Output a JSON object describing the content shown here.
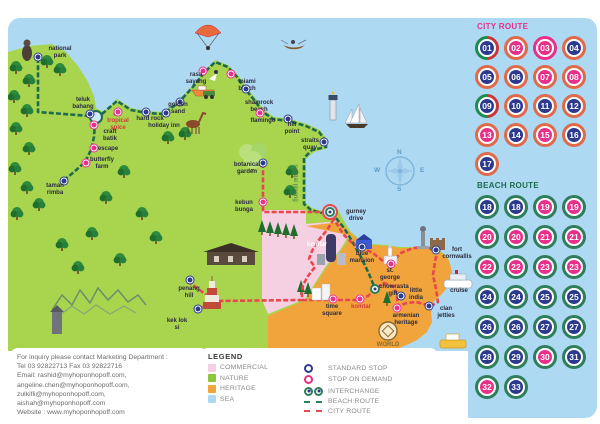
{
  "panels": {
    "city": {
      "title": "CITY ROUTE",
      "badges": [
        {
          "n": "01",
          "fill": "navy",
          "ring": "split"
        },
        {
          "n": "02",
          "fill": "pink",
          "ring": "orange"
        },
        {
          "n": "03",
          "fill": "pink",
          "ring": "pink"
        },
        {
          "n": "04",
          "fill": "navy",
          "ring": "orange"
        },
        {
          "n": "05",
          "fill": "navy",
          "ring": "orange"
        },
        {
          "n": "06",
          "fill": "navy",
          "ring": "orange"
        },
        {
          "n": "07",
          "fill": "pink",
          "ring": "orange"
        },
        {
          "n": "08",
          "fill": "pink",
          "ring": "orange"
        },
        {
          "n": "09",
          "fill": "navy",
          "ring": "split"
        },
        {
          "n": "10",
          "fill": "navy",
          "ring": "orange"
        },
        {
          "n": "11",
          "fill": "navy",
          "ring": "orange"
        },
        {
          "n": "12",
          "fill": "navy",
          "ring": "orange"
        },
        {
          "n": "13",
          "fill": "pink",
          "ring": "orange"
        },
        {
          "n": "14",
          "fill": "navy",
          "ring": "orange"
        },
        {
          "n": "15",
          "fill": "pink",
          "ring": "orange"
        },
        {
          "n": "16",
          "fill": "navy",
          "ring": "orange"
        },
        {
          "n": "17",
          "fill": "navy",
          "ring": "orange"
        }
      ]
    },
    "beach": {
      "title": "BEACH ROUTE",
      "badges": [
        {
          "n": "18",
          "fill": "navy",
          "ring": "green"
        },
        {
          "n": "18",
          "fill": "navy",
          "ring": "green"
        },
        {
          "n": "19",
          "fill": "pink",
          "ring": "green"
        },
        {
          "n": "19",
          "fill": "pink",
          "ring": "green"
        },
        {
          "n": "20",
          "fill": "pink",
          "ring": "green"
        },
        {
          "n": "20",
          "fill": "pink",
          "ring": "green"
        },
        {
          "n": "21",
          "fill": "pink",
          "ring": "green"
        },
        {
          "n": "21",
          "fill": "pink",
          "ring": "green"
        },
        {
          "n": "22",
          "fill": "pink",
          "ring": "green"
        },
        {
          "n": "22",
          "fill": "pink",
          "ring": "green"
        },
        {
          "n": "23",
          "fill": "pink",
          "ring": "green"
        },
        {
          "n": "23",
          "fill": "pink",
          "ring": "green"
        },
        {
          "n": "24",
          "fill": "navy",
          "ring": "green"
        },
        {
          "n": "24",
          "fill": "navy",
          "ring": "green"
        },
        {
          "n": "25",
          "fill": "navy",
          "ring": "green"
        },
        {
          "n": "25",
          "fill": "navy",
          "ring": "green"
        },
        {
          "n": "26",
          "fill": "navy",
          "ring": "green"
        },
        {
          "n": "26",
          "fill": "navy",
          "ring": "green"
        },
        {
          "n": "27",
          "fill": "navy",
          "ring": "green"
        },
        {
          "n": "27",
          "fill": "navy",
          "ring": "green"
        },
        {
          "n": "28",
          "fill": "navy",
          "ring": "green"
        },
        {
          "n": "29",
          "fill": "navy",
          "ring": "green"
        },
        {
          "n": "30",
          "fill": "pink",
          "ring": "green"
        },
        {
          "n": "31",
          "fill": "navy",
          "ring": "green"
        },
        {
          "n": "32",
          "fill": "pink",
          "ring": "green"
        },
        {
          "n": "33",
          "fill": "navy",
          "ring": "green"
        }
      ]
    }
  },
  "colors": {
    "navy": "#2b3a8f",
    "pink": "#e8308a",
    "orange_ring": "#e0694a",
    "pink_ring": "#e8308a",
    "green_ring": "#2e7d5b",
    "split_a": "#1d8a4f",
    "split_b": "#c83737",
    "sea": "#aed9f2",
    "land": "#a8d44e",
    "commercial": "#f5cfe2",
    "heritage": "#f2a43c",
    "city_route": "#e8474b",
    "beach_route": "#1d6b4f"
  },
  "map": {
    "compass": {
      "n": "N",
      "e": "E",
      "s": "S",
      "w": "W"
    },
    "places": [
      {
        "label": "national park",
        "lx": 44,
        "ly": 46,
        "w": 32,
        "sx": 38,
        "sy": 57,
        "type": "standard"
      },
      {
        "label": "teluk bahang",
        "lx": 66,
        "ly": 97,
        "w": 34,
        "sx": 90,
        "sy": 114,
        "type": "standard"
      },
      {
        "label": "craft batik",
        "lx": 97,
        "ly": 129,
        "w": 26,
        "sx": 94,
        "sy": 125,
        "type": "demand"
      },
      {
        "label": "tropical spice",
        "lx": 102,
        "ly": 118,
        "w": 32,
        "sx": 118,
        "sy": 112,
        "type": "demand",
        "color": "#d23b3b"
      },
      {
        "label": "escape",
        "lx": 97,
        "ly": 146,
        "w": 22,
        "sx": 94,
        "sy": 148,
        "type": "demand"
      },
      {
        "label": "butterfly farm",
        "lx": 88,
        "ly": 157,
        "w": 28,
        "sx": 86,
        "sy": 163,
        "type": "demand"
      },
      {
        "label": "taman rimba",
        "lx": 42,
        "ly": 183,
        "w": 26,
        "sx": 64,
        "sy": 181,
        "type": "standard"
      },
      {
        "label": "hard rock",
        "lx": 136,
        "ly": 116,
        "w": 28,
        "sx": 146,
        "sy": 112,
        "type": "standard"
      },
      {
        "label": "holiday inn",
        "lx": 148,
        "ly": 123,
        "w": 32,
        "sx": 166,
        "sy": 113,
        "type": "standard"
      },
      {
        "label": "golden sand",
        "lx": 165,
        "ly": 102,
        "w": 26,
        "sx": 180,
        "sy": 102,
        "type": "standard"
      },
      {
        "label": "rasa sayang",
        "lx": 184,
        "ly": 72,
        "w": 24,
        "sx": 203,
        "sy": 71,
        "type": "demand"
      },
      {
        "label": "miami beach",
        "lx": 234,
        "ly": 79,
        "w": 26,
        "sx": 231,
        "sy": 74,
        "type": "demand"
      },
      {
        "label": "shamrock beach",
        "lx": 243,
        "ly": 100,
        "w": 32,
        "sx": 246,
        "sy": 89,
        "type": "standard"
      },
      {
        "label": "flamingo",
        "lx": 250,
        "ly": 118,
        "w": 26,
        "sx": 260,
        "sy": 113,
        "type": "demand"
      },
      {
        "label": "hill point",
        "lx": 281,
        "ly": 122,
        "w": 22,
        "sx": 288,
        "sy": 119,
        "type": "standard"
      },
      {
        "label": "straits quay",
        "lx": 296,
        "ly": 138,
        "w": 28,
        "sx": 324,
        "sy": 142,
        "type": "standard"
      },
      {
        "label": "botanical garden",
        "lx": 232,
        "ly": 162,
        "w": 30,
        "sx": 263,
        "sy": 163,
        "type": "standard"
      },
      {
        "label": "kebun bunga",
        "lx": 228,
        "ly": 200,
        "w": 32,
        "sx": 263,
        "sy": 202,
        "type": "demand"
      },
      {
        "label": "gurney drive",
        "lx": 344,
        "ly": 209,
        "w": 24,
        "sx": 330,
        "sy": 212,
        "type": "interchange"
      },
      {
        "label": "penang hill",
        "lx": 174,
        "ly": 286,
        "w": 30,
        "sx": 190,
        "sy": 280,
        "type": "standard"
      },
      {
        "label": "kek lok si",
        "lx": 164,
        "ly": 318,
        "w": 26,
        "sx": 198,
        "sy": 309,
        "type": "standard"
      },
      {
        "label": "time square",
        "lx": 320,
        "ly": 304,
        "w": 24,
        "sx": 333,
        "sy": 299,
        "type": "demand"
      },
      {
        "label": "komtar",
        "lx": 350,
        "ly": 304,
        "w": 22,
        "sx": 360,
        "sy": 299,
        "type": "demand",
        "color": "#d23b3b"
      },
      {
        "label": "chowrasta gift",
        "lx": 379,
        "ly": 284,
        "w": 28,
        "sx": 375,
        "sy": 289,
        "type": "interchange"
      },
      {
        "label": "blue mansion",
        "lx": 348,
        "ly": 251,
        "w": 28,
        "sx": 362,
        "sy": 247,
        "type": "standard"
      },
      {
        "label": "st. george",
        "lx": 378,
        "ly": 268,
        "w": 24,
        "sx": 391,
        "sy": 264,
        "type": "demand"
      },
      {
        "label": "fort cornwallis",
        "lx": 442,
        "ly": 247,
        "w": 30,
        "sx": 436,
        "sy": 250,
        "type": "standard"
      },
      {
        "label": "little india",
        "lx": 405,
        "ly": 288,
        "w": 22,
        "sx": 401,
        "sy": 296,
        "type": "standard"
      },
      {
        "label": "clan jetties",
        "lx": 435,
        "ly": 306,
        "w": 22,
        "sx": 429,
        "sy": 306,
        "type": "standard"
      },
      {
        "label": "armenian heritage",
        "lx": 392,
        "ly": 313,
        "w": 28,
        "sx": 397,
        "sy": 308,
        "type": "demand"
      },
      {
        "label": "cruise",
        "lx": 448,
        "ly": 288,
        "w": 22,
        "type": "none"
      },
      {
        "label": "komtar",
        "lx": 306,
        "ly": 242,
        "w": 22,
        "type": "none",
        "color": "#ffffff"
      },
      {
        "label": "WORLD HERITAGE",
        "lx": 370,
        "ly": 342,
        "w": 36,
        "type": "none",
        "color": "#8a6a2a"
      },
      {
        "label": "sungai pinang",
        "lx": 298,
        "ly": 162,
        "w": 42,
        "type": "none",
        "color": "#4a7a3a",
        "rot": 90
      }
    ]
  },
  "legend": {
    "title": "LEGEND",
    "areas": [
      {
        "label": "COMMERCIAL",
        "color": "#f5cfe2"
      },
      {
        "label": "NATURE",
        "color": "#8cc63f"
      },
      {
        "label": "HERITAGE",
        "color": "#f2a43c"
      },
      {
        "label": "SEA",
        "color": "#aed9f2"
      }
    ],
    "symbols": [
      {
        "label": "STANDARD STOP",
        "type": "standard"
      },
      {
        "label": "STOP ON DEMAND",
        "type": "demand"
      },
      {
        "label": "INTERCHANGE",
        "type": "interchange"
      },
      {
        "label": "BEACH ROUTE",
        "type": "beach"
      },
      {
        "label": "CITY ROUTE",
        "type": "city"
      }
    ]
  },
  "contact": {
    "lines": [
      "For inquiry please contact Marketing Department :",
      "Tel 03 92822713 Fax 03 92822716",
      "Email: rashid@myhoponhopoff.com,",
      "angeline.chen@myhoponhopoff.com,",
      "zulkifli@myhoponhopoff.com,",
      "aishah@myhoponhopoff.com",
      "Website : www.myhoponhopoff.com"
    ]
  }
}
